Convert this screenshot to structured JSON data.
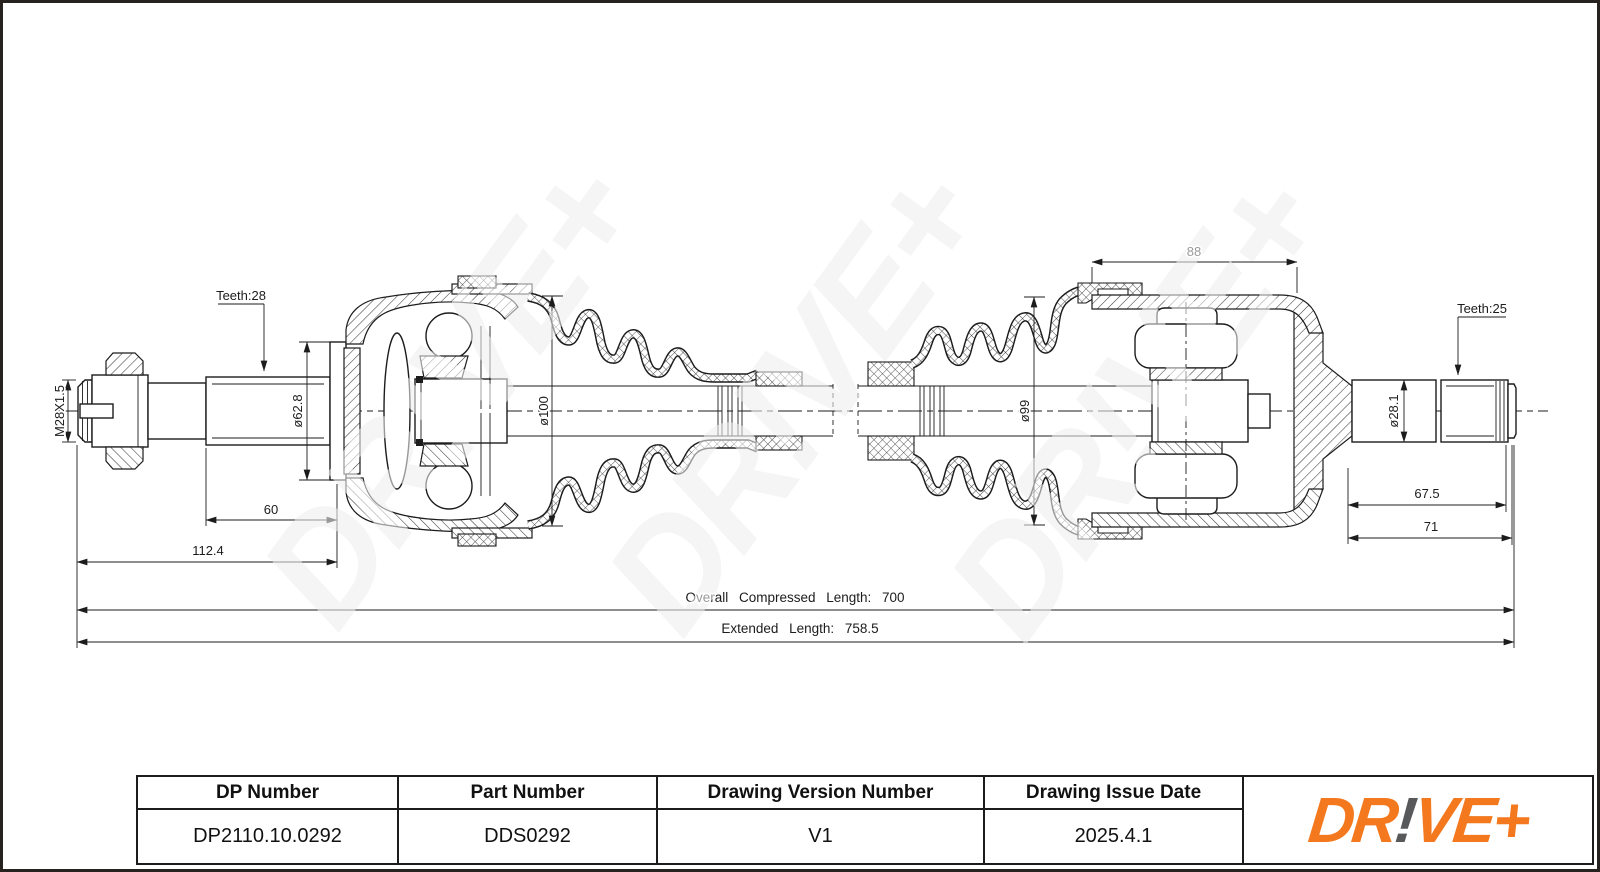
{
  "watermark": {
    "text": "DR!VE+"
  },
  "drawing": {
    "labels": {
      "thread_spec": "M28X1.5",
      "teeth_left": "Teeth:28",
      "teeth_right": "Teeth:25",
      "dia_shaft_left": "ø62.8",
      "dia_boot_left": "ø100",
      "dia_boot_right": "ø99",
      "dia_shaft_right": "ø28.1",
      "len_spline_left": "60",
      "len_stub_left": "112.4",
      "len_joint_right": "88",
      "len_spline_right": "67.5",
      "len_stub_right": "71",
      "overall_compressed": "Overall Compressed Length: 700",
      "extended": "Extended Length: 758.5"
    }
  },
  "title_block": {
    "headers": [
      "DP Number",
      "Part Number",
      "Drawing Version Number",
      "Drawing Issue Date"
    ],
    "values": [
      "DP2110.10.0292",
      "DDS0292",
      "V1",
      "2025.4.1"
    ]
  },
  "logo": {
    "seg1": "DR",
    "seg2": "!",
    "seg3": "VE+"
  },
  "colors": {
    "logo_orange": "#F4791E",
    "logo_gray": "#58595B",
    "line": "#1c1c1c",
    "watermark_gray": "#e8e8e8"
  }
}
